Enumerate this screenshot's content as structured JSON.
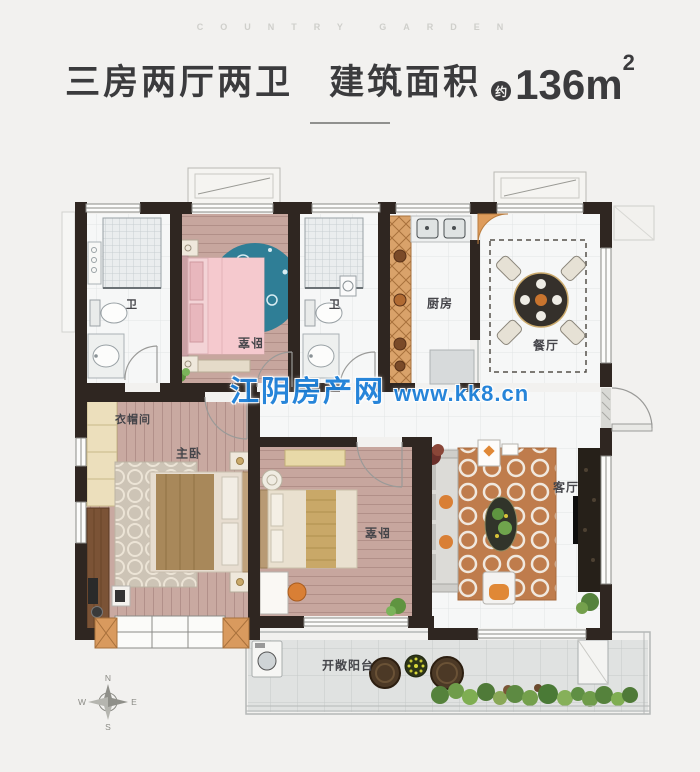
{
  "brand": {
    "text": "COUNTRY GARDEN"
  },
  "header": {
    "layout_title": "三房两厅两卫",
    "area_label": "建筑面积",
    "approx_badge": "约",
    "area_value": "136m",
    "area_exponent": "2"
  },
  "watermark": {
    "site_name": "江阴房产网",
    "site_url": "www.kk8.cn"
  },
  "rooms": {
    "bath_left": "卫",
    "bedroom_top": "卧室",
    "bath_right": "卫",
    "kitchen": "厨房",
    "dining": "餐厅",
    "cloakroom": "衣帽间",
    "master_bedroom": "主卧",
    "bedroom_second": "卧室",
    "living": "客厅",
    "balcony": "开敞阳台"
  },
  "compass": {
    "north": "N",
    "east": "E",
    "south": "S",
    "west": "W"
  },
  "colors": {
    "background": "#f2f1ef",
    "title_text": "#3b3b3d",
    "wall_dark": "#2f2621",
    "watermark_blue": "#1c7fd8",
    "wood_floor_pink": "#c9a9a1",
    "rug_blue": "#2f7e96",
    "living_rug_orange": "#bf7c4c",
    "cabinet_orange": "#d9a26a"
  }
}
